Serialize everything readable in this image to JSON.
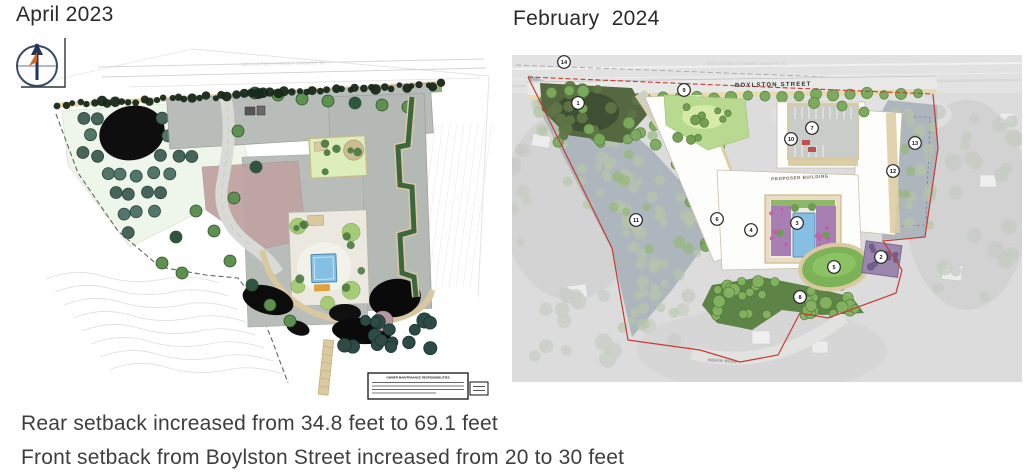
{
  "left_panel": {
    "title": "April 2023",
    "street_label": "BOYLSTON STREET (ROUTE 9)",
    "compass_north_label": "N",
    "maintenance_box_title": "OWNER MAINTENANCE RESPONSIBILITIES"
  },
  "right_panel": {
    "title": "February  2024",
    "highway_label": "BOYLSTON STREET (ROUTE 9)",
    "street_label": "BOYLSTON STREET",
    "building_label": "PROPOSED BUILDING",
    "road_label": "HEATH ROAD",
    "markers": [
      {
        "n": "1",
        "x": 66,
        "y": 48
      },
      {
        "n": "2",
        "x": 369,
        "y": 202
      },
      {
        "n": "3",
        "x": 285,
        "y": 168
      },
      {
        "n": "4",
        "x": 239,
        "y": 175
      },
      {
        "n": "5",
        "x": 322,
        "y": 212
      },
      {
        "n": "6",
        "x": 205,
        "y": 164
      },
      {
        "n": "7",
        "x": 300,
        "y": 73
      },
      {
        "n": "8",
        "x": 288,
        "y": 242
      },
      {
        "n": "9",
        "x": 172,
        "y": 35
      },
      {
        "n": "10",
        "x": 279,
        "y": 84
      },
      {
        "n": "11",
        "x": 124,
        "y": 165
      },
      {
        "n": "12",
        "x": 381,
        "y": 116
      },
      {
        "n": "13",
        "x": 403,
        "y": 88
      },
      {
        "n": "14",
        "x": 52,
        "y": 7
      }
    ]
  },
  "captions": {
    "line1": "Rear setback increased from 34.8 feet to 69.1 feet",
    "line2": "Front setback from Boylston Street increased from 20 to 30 feet"
  },
  "colors": {
    "boundary_red": "#c43b33",
    "pool_blue": "#85bfe4",
    "lawn_green": "#7db356",
    "caption_text": "#3e3e3e"
  }
}
